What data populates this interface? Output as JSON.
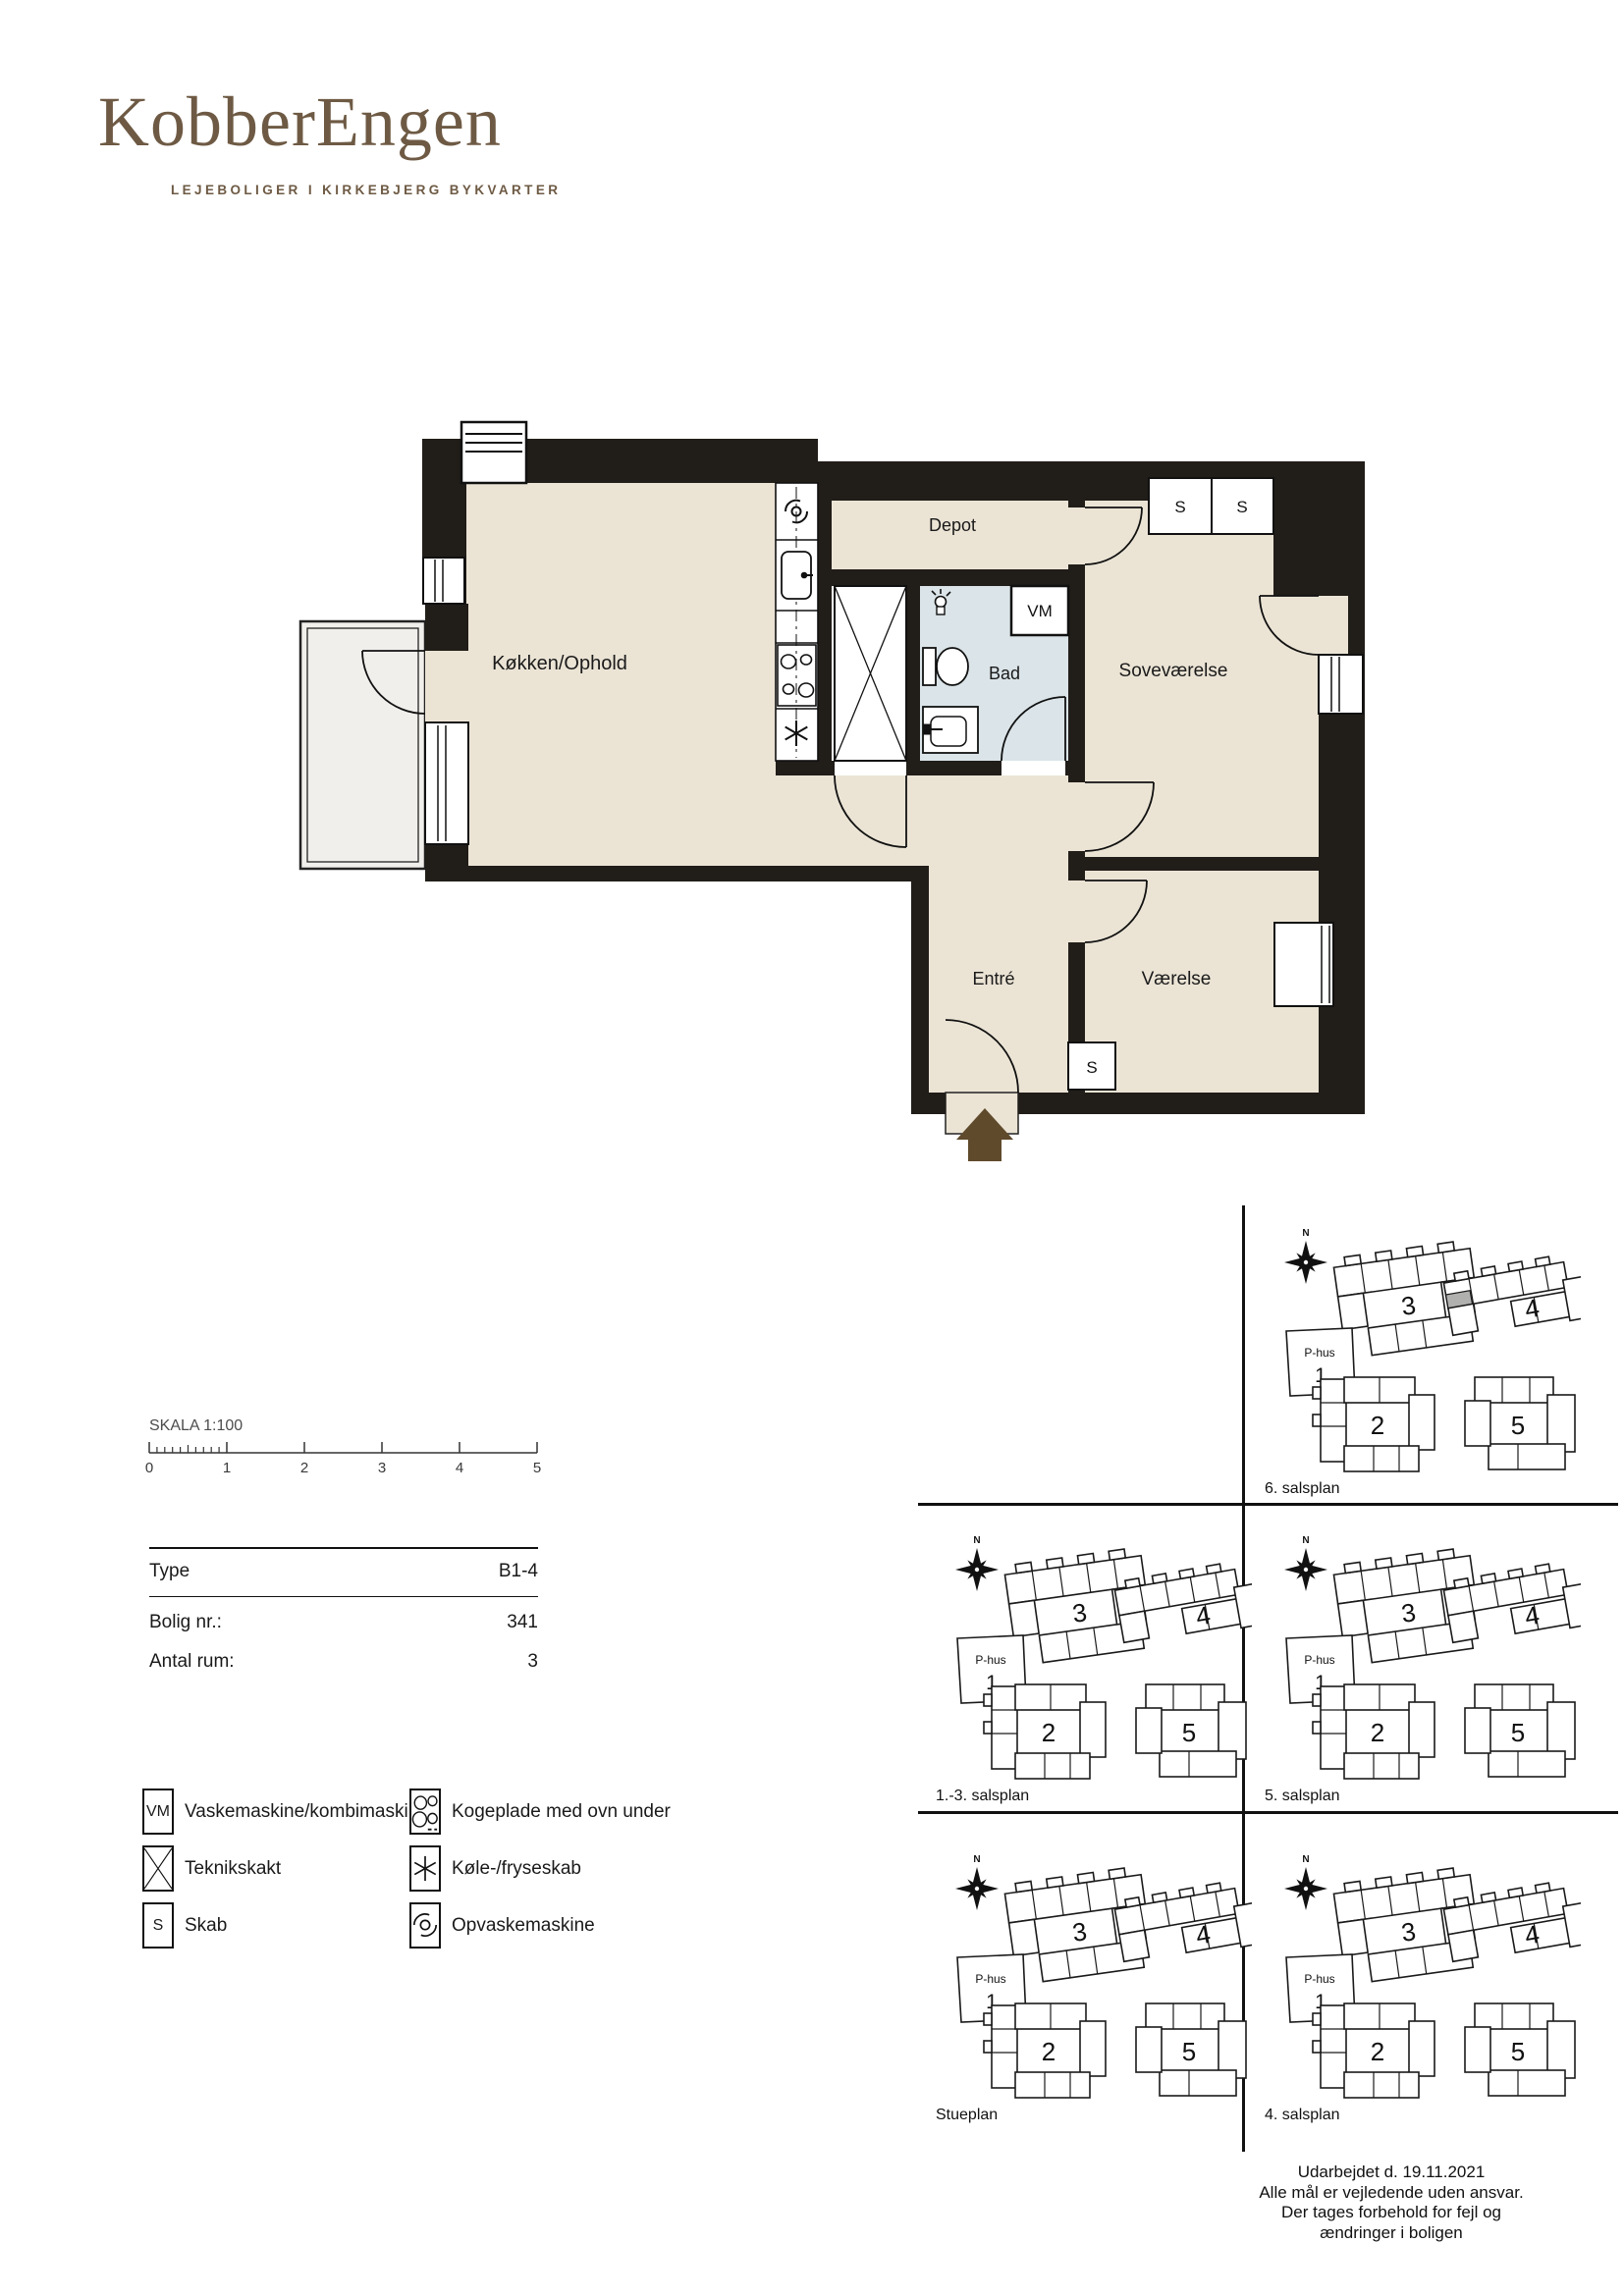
{
  "brand": {
    "logo": "KobberEngen",
    "tagline": "LEJEBOLIGER I KIRKEBJERG BYKVARTER"
  },
  "floorplan": {
    "rooms": {
      "kitchen_living": "Køkken/Ophold",
      "depot": "Depot",
      "bath": "Bad",
      "bedroom": "Soveværelse",
      "entry": "Entré",
      "room": "Værelse"
    },
    "markers": {
      "washing_machine": "VM",
      "cabinet": "S"
    }
  },
  "scalebar": {
    "label": "SKALA 1:100",
    "ticks": [
      "0",
      "1",
      "2",
      "3",
      "4",
      "5"
    ]
  },
  "info": {
    "rows": [
      {
        "label": "Type",
        "value": "B1-4"
      },
      {
        "label": "Bolig nr.:",
        "value": "341"
      },
      {
        "label": "Antal rum:",
        "value": "3"
      }
    ]
  },
  "legend": {
    "items_left": [
      {
        "symbol": "VM",
        "label": "Vaskemaskine/kombimaskine"
      },
      {
        "symbol": "X",
        "label": "Teknikskakt"
      },
      {
        "symbol": "S",
        "label": "Skab"
      }
    ],
    "items_right": [
      {
        "icon": "cooktop-icon",
        "label": "Kogeplade med ovn under"
      },
      {
        "icon": "fridge-freezer-icon",
        "label": "Køle-/fryseskab"
      },
      {
        "icon": "dishwasher-icon",
        "label": "Opvaskemaskine"
      }
    ]
  },
  "siteplans": {
    "north": "N",
    "phus": {
      "label": "P-hus",
      "number": "1"
    },
    "buildings": {
      "b2": "2",
      "b3": "3",
      "b4": "4",
      "b5": "5"
    },
    "panels": [
      {
        "label": "6. salsplan",
        "highlight": true
      },
      {
        "label": "1.-3. salsplan",
        "highlight": false
      },
      {
        "label": "5. salsplan",
        "highlight": false
      },
      {
        "label": "Stueplan",
        "highlight": false
      },
      {
        "label": "4. salsplan",
        "highlight": false
      }
    ]
  },
  "footer": {
    "lines": [
      "Udarbejdet d. 19.11.2021",
      "Alle mål er vejledende uden ansvar.",
      "Der tages forbehold for fejl og",
      "ændringer i boligen"
    ]
  },
  "colors": {
    "wall": "#211d19",
    "floor": "#ebe4d5",
    "bath": "#dbe4e8",
    "balcony": "#f1efec",
    "accent_brown": "#6e5a44",
    "arrow_brown": "#5f4a2c",
    "highlight_gray": "#b0b0af"
  }
}
